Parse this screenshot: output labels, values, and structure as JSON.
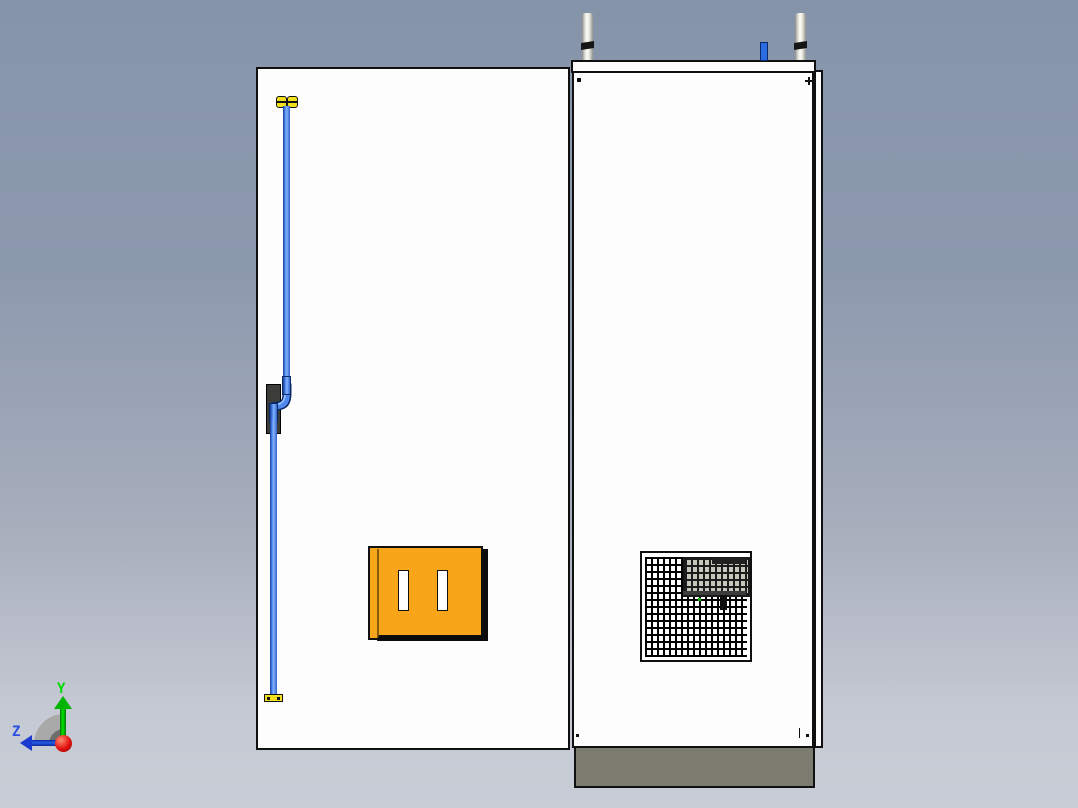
{
  "app": {
    "type": "cad-3d-viewport",
    "view": "front-elevation"
  },
  "background": {
    "gradient_top": "#8694aa",
    "gradient_bottom": "#c9cdd6"
  },
  "triad": {
    "y_label": "Y",
    "z_label": "Z",
    "y_axis_color": "#00cc00",
    "z_axis_color": "#1a3ad0",
    "origin_color": "#e21212",
    "arc_color": "#a9a9a9"
  },
  "model": {
    "name": "electrical-cabinet-enclosure",
    "door_panel": {
      "fill": "#fdfdfd",
      "outline": "#101010"
    },
    "side_panel": {
      "fill": "#fdfdfd",
      "outline": "#101010"
    },
    "plinth": {
      "fill": "#7b7b70",
      "outline": "#101010"
    },
    "socket": {
      "fill": "#f9a51a",
      "slot_fill": "#ffffff",
      "slot_count": 2
    },
    "pipe": {
      "fill": "#4f89ee",
      "edge": "#173a93",
      "fittings": "#f2df1d",
      "bracket": "#3c3c38"
    },
    "vent": {
      "frame": "#ffffff",
      "grid_line": "#000000",
      "insert_fill": "#c6c6bc",
      "indicator_dot": "#00b400"
    },
    "eyebolts": {
      "count": 2,
      "fill": "#e9e9e2",
      "band": "#161616"
    },
    "clip": {
      "fill": "#2a6de0"
    }
  }
}
